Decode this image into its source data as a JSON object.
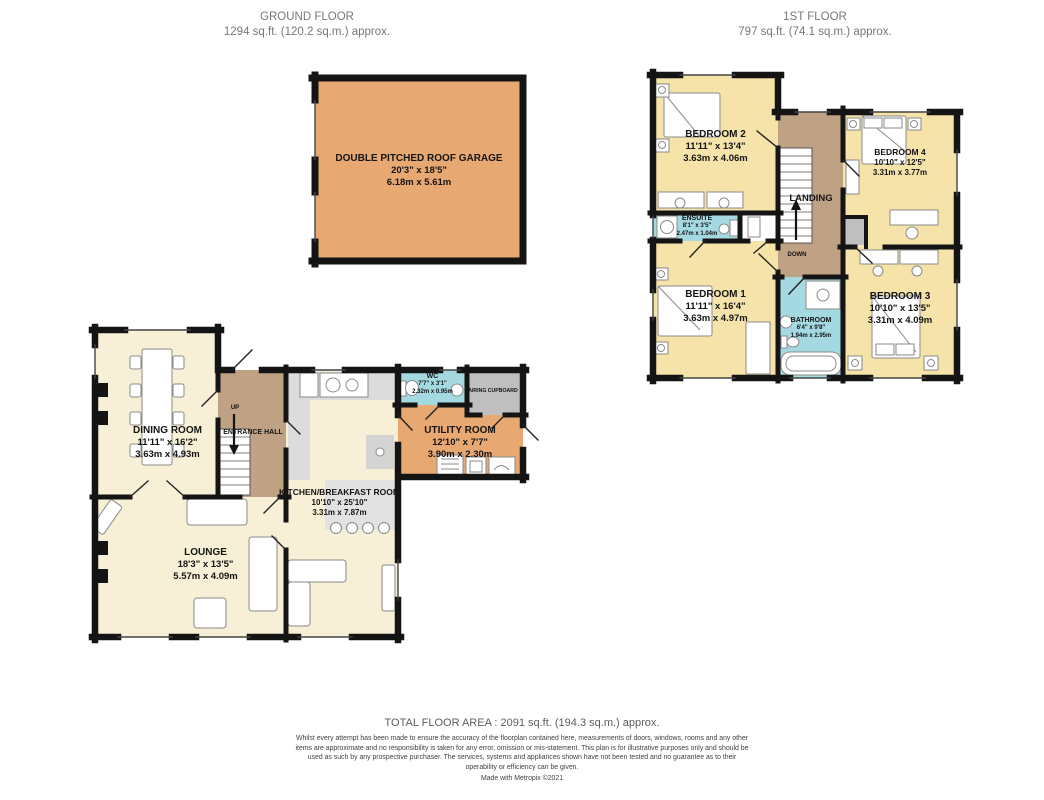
{
  "ground_floor": {
    "title": "GROUND FLOOR",
    "area": "1294 sq.ft. (120.2 sq.m.) approx.",
    "rooms": {
      "garage": {
        "name": "DOUBLE PITCHED ROOF GARAGE",
        "imperial": "20'3\" x 18'5\"",
        "metric": "6.18m x 5.61m"
      },
      "dining": {
        "name": "DINING ROOM",
        "imperial": "11'11\" x 16'2\"",
        "metric": "3.63m x 4.93m"
      },
      "entrance_hall": {
        "name": "ENTRANCE HALL",
        "stairs_label": "UP"
      },
      "lounge": {
        "name": "LOUNGE",
        "imperial": "18'3\" x 13'5\"",
        "metric": "5.57m x 4.09m"
      },
      "kitchen": {
        "name": "KITCHEN/BREAKFAST ROOM",
        "imperial": "10'10\" x 25'10\"",
        "metric": "3.31m x 7.87m"
      },
      "wc": {
        "name": "WC",
        "imperial": "7'7\" x 3'1\"",
        "metric": "2.32m x 0.95m"
      },
      "airing_cupboard": {
        "name": "AIRING CUPBOARD"
      },
      "utility": {
        "name": "UTILITY ROOM",
        "imperial": "12'10\" x 7'7\"",
        "metric": "3.90m x 2.30m"
      }
    }
  },
  "first_floor": {
    "title": "1ST FLOOR",
    "area": "797 sq.ft. (74.1 sq.m.) approx.",
    "rooms": {
      "bedroom2": {
        "name": "BEDROOM 2",
        "imperial": "11'11\" x 13'4\"",
        "metric": "3.63m x 4.06m"
      },
      "bedroom4": {
        "name": "BEDROOM 4",
        "imperial": "10'10\" x 12'5\"",
        "metric": "3.31m x 3.77m"
      },
      "landing": {
        "name": "LANDING",
        "stairs_label": "DOWN"
      },
      "ensuite": {
        "name": "ENSUITE",
        "imperial": "8'1\" x 3'5\"",
        "metric": "2.47m x 1.04m"
      },
      "bedroom1": {
        "name": "BEDROOM 1",
        "imperial": "11'11\" x 16'4\"",
        "metric": "3.63m x 4.97m"
      },
      "bathroom": {
        "name": "BATHROOM",
        "imperial": "6'4\" x 9'8\"",
        "metric": "1.94m x 2.95m"
      },
      "bedroom3": {
        "name": "BEDROOM 3",
        "imperial": "10'10\" x 13'5\"",
        "metric": "3.31m x 4.09m"
      }
    }
  },
  "footer": {
    "total": "TOTAL FLOOR AREA : 2091 sq.ft. (194.3 sq.m.) approx.",
    "disclaimer": "Whilst every attempt has been made to ensure the accuracy of the floorplan contained here, measurements of doors, windows, rooms and any other items are approximate and no responsibility is taken for any error, omission or mis-statement. This plan is for illustrative purposes only and should be used as such by any prospective purchaser. The services, systems and appliances shown have not been tested and no guarantee as to their operability or efficiency can be given.",
    "credit": "Made with Metropix ©2021"
  },
  "palette": {
    "wall": "#141414",
    "room_cream": "#F7EFD6",
    "room_yellow": "#F5E3A9",
    "hall_brown": "#BFA183",
    "garage_orange": "#E8A872",
    "wet_blue": "#A5D9E1",
    "cupboard_gray": "#BFBFBF",
    "counter_gray": "#DCDCDC"
  }
}
